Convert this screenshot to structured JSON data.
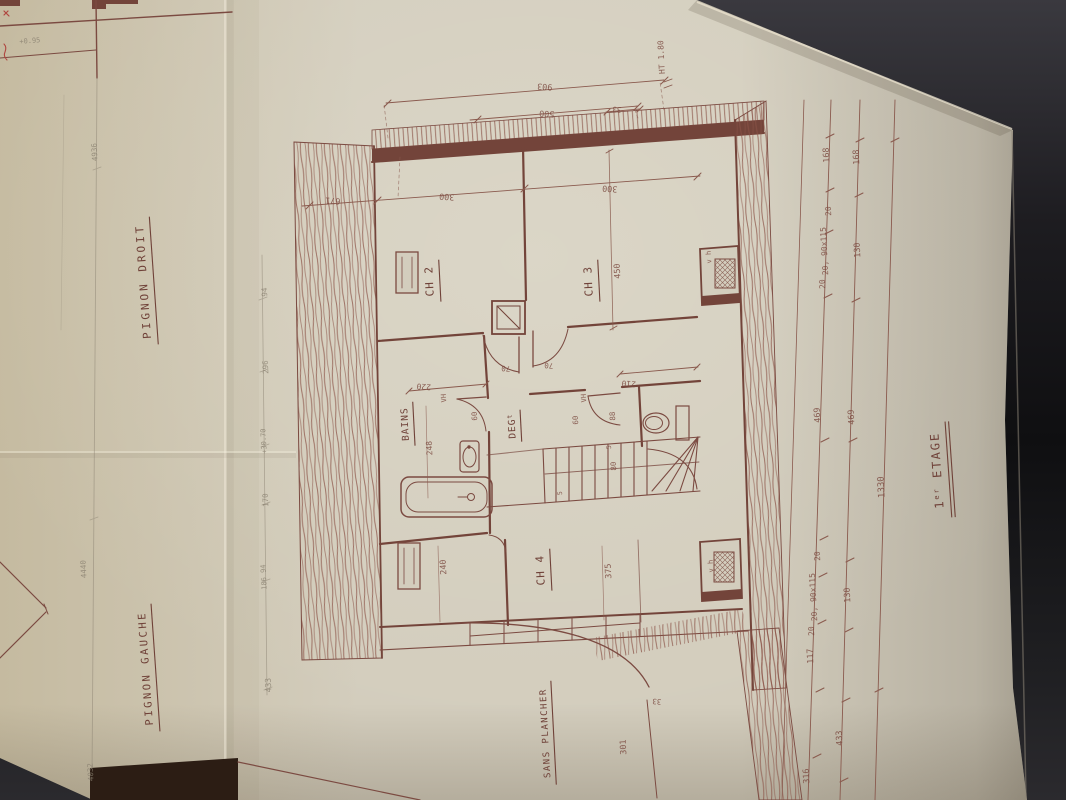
{
  "document": {
    "type": "architectural floor plan photograph",
    "sheet_labels": {
      "pignon_droit": "PIGNON DROIT",
      "pignon_gauche": "PIGNON GAUCHE",
      "floor_title": "1er ETAGE"
    },
    "rooms": [
      "CH 2",
      "CH 3",
      "CH 4",
      "BAINS",
      "DEG",
      "SANS PLANCHER"
    ],
    "colors": {
      "ink": "#6f4138",
      "wall_fill": "#73443a",
      "paper": "#d3cdbd",
      "pencil": "#8a8171",
      "background": "#141316",
      "red_mark": "#b0453f"
    }
  },
  "texts": [
    {
      "t": "PIGNON  DROIT",
      "x": 147,
      "y": 281,
      "r": -94,
      "s": 11,
      "ls": 3,
      "u": 128,
      "c": "ink",
      "n": "label-pignon-droit"
    },
    {
      "t": "PIGNON  GAUCHE",
      "x": 149,
      "y": 668,
      "r": -94,
      "s": 10.5,
      "ls": 2.5,
      "u": 128,
      "c": "ink",
      "n": "label-pignon-gauche"
    },
    {
      "parts": [
        {
          "t": "1"
        },
        {
          "t": "er",
          "dy": -4,
          "s": 7
        },
        {
          "t": " ETAGE",
          "dy": 4
        }
      ],
      "x": 941,
      "y": 470,
      "r": -94,
      "s": 12,
      "ls": 2,
      "u": 96,
      "du": true,
      "c": "ink",
      "n": "label-floor-title"
    },
    {
      "t": "CH 2",
      "x": 433,
      "y": 281,
      "r": -93,
      "s": 11,
      "ls": 1,
      "u": 42,
      "c": "ink",
      "n": "room-label-ch2"
    },
    {
      "t": "CH 3",
      "x": 592,
      "y": 281,
      "r": -93,
      "s": 11,
      "ls": 1,
      "u": 42,
      "c": "ink",
      "n": "room-label-ch3"
    },
    {
      "t": "CH 4",
      "x": 544,
      "y": 570,
      "r": -93,
      "s": 11,
      "ls": 1,
      "u": 42,
      "c": "ink",
      "n": "room-label-ch4"
    },
    {
      "t": "BAINS",
      "x": 408,
      "y": 424,
      "r": -93,
      "s": 9.5,
      "ls": 1,
      "u": 44,
      "c": "ink",
      "n": "room-label-bains"
    },
    {
      "parts": [
        {
          "t": "DEG"
        },
        {
          "t": "t",
          "dy": -3,
          "s": 6.5
        }
      ],
      "x": 515,
      "y": 426,
      "r": -93,
      "s": 9.5,
      "ls": 1,
      "u": 32,
      "c": "ink",
      "n": "room-label-deg"
    },
    {
      "t": "SANS PLANCHER",
      "x": 548,
      "y": 733,
      "r": -93,
      "s": 9,
      "ls": 1.5,
      "u": 104,
      "c": "ink",
      "n": "label-sans-plancher"
    },
    {
      "t": "VH",
      "x": 446,
      "y": 398,
      "r": -93,
      "s": 7,
      "c": "ink2",
      "n": "anno-vh-bains"
    },
    {
      "t": "VH",
      "x": 586,
      "y": 398,
      "r": -93,
      "s": 7,
      "c": "ink2",
      "n": "anno-vh-wc"
    },
    {
      "t": "v h",
      "x": 711,
      "y": 257,
      "r": -93,
      "s": 7,
      "c": "ink2",
      "n": "anno-vh-upper"
    },
    {
      "t": "v h",
      "x": 713,
      "y": 566,
      "r": -93,
      "s": 7,
      "c": "ink2",
      "n": "anno-vh-lower"
    },
    {
      "t": "HT 1.80",
      "x": 664,
      "y": 57,
      "r": -93,
      "s": 8,
      "c": "ink2",
      "n": "anno-ht-180"
    },
    {
      "t": "+0.95",
      "x": 30,
      "y": 43,
      "r": -4,
      "s": 7,
      "c": "pencil",
      "n": "anno-level"
    },
    {
      "t": "903",
      "x": 545,
      "y": 84,
      "r": 184,
      "s": 8.5,
      "c": "ink2",
      "n": "dim-903"
    },
    {
      "t": "500",
      "x": 547,
      "y": 111,
      "r": 184,
      "s": 8.5,
      "c": "ink2",
      "n": "dim-500"
    },
    {
      "t": "33",
      "x": 617,
      "y": 107,
      "r": 184,
      "s": 7.5,
      "c": "ink2",
      "n": "dim-33-top"
    },
    {
      "t": "671",
      "x": 333,
      "y": 198,
      "r": 184,
      "s": 8.5,
      "c": "ink2",
      "n": "dim-671"
    },
    {
      "t": "300",
      "x": 447,
      "y": 194,
      "r": 184,
      "s": 8.5,
      "c": "ink2",
      "n": "dim-300-ch2"
    },
    {
      "t": "300",
      "x": 610,
      "y": 186,
      "r": 184,
      "s": 8.5,
      "c": "ink2",
      "n": "dim-300-ch3"
    },
    {
      "t": "450",
      "x": 620,
      "y": 271,
      "r": -93,
      "s": 8.5,
      "c": "ink2",
      "n": "dim-450"
    },
    {
      "t": "220",
      "x": 424,
      "y": 384,
      "r": 184,
      "s": 8,
      "c": "ink2",
      "n": "dim-220"
    },
    {
      "t": "210",
      "x": 629,
      "y": 381,
      "r": 184,
      "s": 8,
      "c": "ink2",
      "n": "dim-210"
    },
    {
      "t": "70",
      "x": 506,
      "y": 366,
      "r": 184,
      "s": 7.5,
      "c": "ink2",
      "n": "dim-70-left"
    },
    {
      "t": "70",
      "x": 549,
      "y": 363,
      "r": 184,
      "s": 7.5,
      "c": "ink2",
      "n": "dim-70-right"
    },
    {
      "t": "60",
      "x": 477,
      "y": 416,
      "r": -93,
      "s": 7.5,
      "c": "ink2",
      "n": "dim-60-bains"
    },
    {
      "t": "60",
      "x": 578,
      "y": 420,
      "r": -93,
      "s": 7.5,
      "c": "ink2",
      "n": "dim-60-wc"
    },
    {
      "t": "88",
      "x": 615,
      "y": 416,
      "r": -93,
      "s": 7.5,
      "c": "ink2",
      "n": "dim-88"
    },
    {
      "t": "80",
      "x": 616,
      "y": 466,
      "r": -93,
      "s": 7.5,
      "c": "ink2",
      "n": "dim-80"
    },
    {
      "t": "5",
      "x": 562,
      "y": 493,
      "r": -93,
      "s": 6.5,
      "c": "ink2",
      "n": "dim-5a"
    },
    {
      "t": "5",
      "x": 611,
      "y": 447,
      "r": -93,
      "s": 6.5,
      "c": "ink2",
      "n": "dim-5b"
    },
    {
      "t": "248",
      "x": 432,
      "y": 448,
      "r": -93,
      "s": 8,
      "c": "ink2",
      "n": "dim-248"
    },
    {
      "t": "240",
      "x": 446,
      "y": 567,
      "r": -93,
      "s": 8.5,
      "c": "ink2",
      "n": "dim-240"
    },
    {
      "t": "375",
      "x": 611,
      "y": 571,
      "r": -93,
      "s": 8.5,
      "c": "ink2",
      "n": "dim-375"
    },
    {
      "t": "301",
      "x": 626,
      "y": 747,
      "r": -93,
      "s": 8.5,
      "c": "ink2",
      "n": "dim-301"
    },
    {
      "t": "33",
      "x": 657,
      "y": 699,
      "r": 184,
      "s": 7.5,
      "c": "ink2",
      "n": "dim-33-bottom"
    },
    {
      "t": "168",
      "x": 829,
      "y": 155,
      "r": -93,
      "s": 8.5,
      "c": "ink2",
      "n": "dim-168-a"
    },
    {
      "t": "168",
      "x": 859,
      "y": 157,
      "r": -93,
      "s": 8.5,
      "c": "ink2",
      "n": "dim-168-b"
    },
    {
      "t": "20",
      "x": 831,
      "y": 211,
      "r": -93,
      "s": 8,
      "c": "ink2",
      "n": "dim-20-a"
    },
    {
      "t": "20, 90x115",
      "x": 827,
      "y": 251,
      "r": -93,
      "s": 8,
      "c": "ink2",
      "n": "dim-window-a"
    },
    {
      "t": "20",
      "x": 825,
      "y": 284,
      "r": -93,
      "s": 8,
      "c": "ink2",
      "n": "dim-20-b"
    },
    {
      "t": "130",
      "x": 860,
      "y": 250,
      "r": -93,
      "s": 8.5,
      "c": "ink2",
      "n": "dim-130-a"
    },
    {
      "t": "469",
      "x": 820,
      "y": 415,
      "r": -93,
      "s": 8.5,
      "c": "ink2",
      "n": "dim-469-a"
    },
    {
      "t": "469",
      "x": 854,
      "y": 417,
      "r": -93,
      "s": 8.5,
      "c": "ink2",
      "n": "dim-469-b"
    },
    {
      "t": "1330",
      "x": 884,
      "y": 487,
      "r": -93,
      "s": 9,
      "c": "ink2",
      "n": "dim-1330"
    },
    {
      "t": "20",
      "x": 820,
      "y": 556,
      "r": -93,
      "s": 8,
      "c": "ink2",
      "n": "dim-20-c"
    },
    {
      "t": "20, 90x115",
      "x": 816,
      "y": 597,
      "r": -93,
      "s": 8,
      "c": "ink2",
      "n": "dim-window-b"
    },
    {
      "t": "20",
      "x": 814,
      "y": 631,
      "r": -93,
      "s": 8,
      "c": "ink2",
      "n": "dim-20-d"
    },
    {
      "t": "130",
      "x": 850,
      "y": 595,
      "r": -93,
      "s": 8.5,
      "c": "ink2",
      "n": "dim-130-b"
    },
    {
      "t": "117",
      "x": 813,
      "y": 656,
      "r": -93,
      "s": 8.5,
      "c": "ink2",
      "n": "dim-117"
    },
    {
      "t": "433",
      "x": 842,
      "y": 738,
      "r": -93,
      "s": 8.5,
      "c": "ink2",
      "n": "dim-433-right"
    },
    {
      "t": "316",
      "x": 809,
      "y": 776,
      "r": -93,
      "s": 8.5,
      "c": "ink2",
      "n": "dim-316"
    },
    {
      "t": "94",
      "x": 267,
      "y": 292,
      "r": -93,
      "s": 7.5,
      "c": "pencil",
      "n": "dim-94"
    },
    {
      "t": "296",
      "x": 268,
      "y": 367,
      "r": -93,
      "s": 7.5,
      "c": "pencil",
      "n": "dim-296"
    },
    {
      "t": "+30.70",
      "x": 266,
      "y": 441,
      "r": -93,
      "s": 7,
      "c": "pencil",
      "n": "dim-3070"
    },
    {
      "t": "170",
      "x": 268,
      "y": 500,
      "r": -93,
      "s": 7.5,
      "c": "pencil",
      "n": "dim-170"
    },
    {
      "t": "186 94",
      "x": 266,
      "y": 577,
      "r": -93,
      "s": 7,
      "c": "pencil",
      "n": "dim-18694"
    },
    {
      "t": "433",
      "x": 271,
      "y": 685,
      "r": -93,
      "s": 8,
      "c": "pencil",
      "n": "dim-433-left"
    },
    {
      "t": "4936",
      "x": 97,
      "y": 152,
      "r": -93,
      "s": 7.5,
      "c": "pencil",
      "n": "dim-4936"
    },
    {
      "t": "4440",
      "x": 86,
      "y": 569,
      "r": -93,
      "s": 7.5,
      "c": "pencil",
      "n": "dim-4440"
    },
    {
      "t": "4032",
      "x": 93,
      "y": 772,
      "r": -93,
      "s": 7.5,
      "c": "pencil",
      "n": "dim-4032"
    }
  ]
}
